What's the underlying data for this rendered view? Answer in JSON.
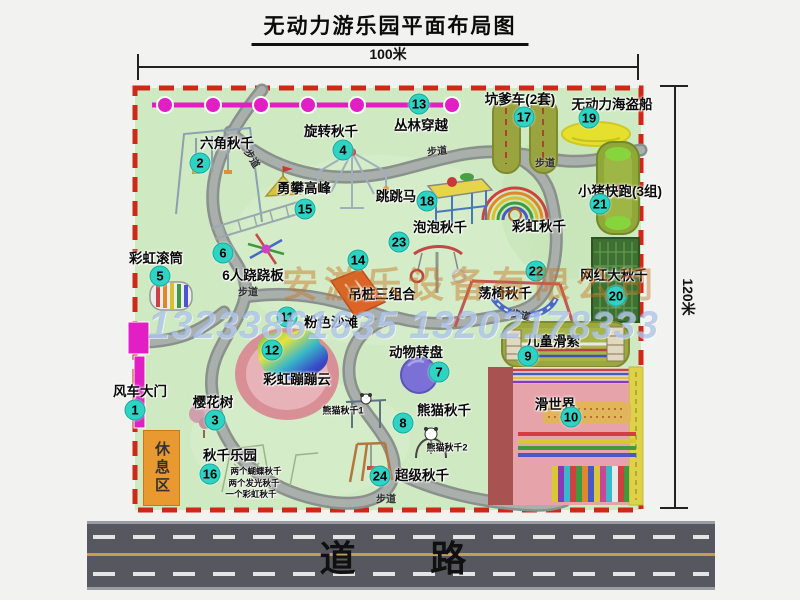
{
  "title": "无动力游乐园平面布局图",
  "dims": {
    "width": "100米",
    "height": "120米"
  },
  "road": {
    "label": "道 路"
  },
  "watermark": {
    "company": "安游乐设备有限公司",
    "phones": "13233861635 13202178333"
  },
  "area": {
    "rest": "休息区",
    "walkway": "步道",
    "rainbow_swing": "彩虹秋千"
  },
  "items": {
    "i1": {
      "num": "1",
      "label": "风车大门"
    },
    "i2": {
      "num": "2",
      "label": "六角秋千"
    },
    "i3": {
      "num": "3",
      "label": "樱花树"
    },
    "i4": {
      "num": "4",
      "label": "旋转秋千"
    },
    "i5": {
      "num": "5",
      "label": "彩虹滚筒"
    },
    "i6": {
      "num": "6",
      "label": "6人跷跷板"
    },
    "i7": {
      "num": "7",
      "label": "动物转盘"
    },
    "i8": {
      "num": "8",
      "label": "熊猫秋千"
    },
    "i9": {
      "num": "9",
      "label": "儿童滑索"
    },
    "i10": {
      "num": "10",
      "label": "滑世界"
    },
    "i11": {
      "num": "11",
      "label": "粉色沙滩"
    },
    "i12": {
      "num": "12",
      "label": "彩虹蹦蹦云"
    },
    "i13": {
      "num": "13",
      "label": "丛林穿越"
    },
    "i14": {
      "num": "14",
      "label": "吊桩三组合"
    },
    "i15": {
      "num": "15",
      "label": "勇攀高峰"
    },
    "i16": {
      "num": "16",
      "label": "秋千乐园"
    },
    "i17": {
      "num": "17",
      "label": "坑爹车(2套)"
    },
    "i18": {
      "num": "18",
      "label": "跳跳马"
    },
    "i19": {
      "num": "19",
      "label": "无动力海盗船"
    },
    "i20": {
      "num": "20",
      "label": "网红大秋千"
    },
    "i21": {
      "num": "21",
      "label": "小猪快跑(3组)"
    },
    "i22": {
      "num": "22",
      "label": "荡椅秋千"
    },
    "i23": {
      "num": "23",
      "label": "泡泡秋千"
    },
    "i24": {
      "num": "24",
      "label": "超级秋千"
    }
  },
  "notes": {
    "panda1": "熊猫秋千1",
    "panda2": "熊猫秋千2",
    "swing_note1": "两个蝴蝶秋千",
    "swing_note2": "两个发光秋千",
    "swing_note3": "一个彩虹秋千"
  }
}
